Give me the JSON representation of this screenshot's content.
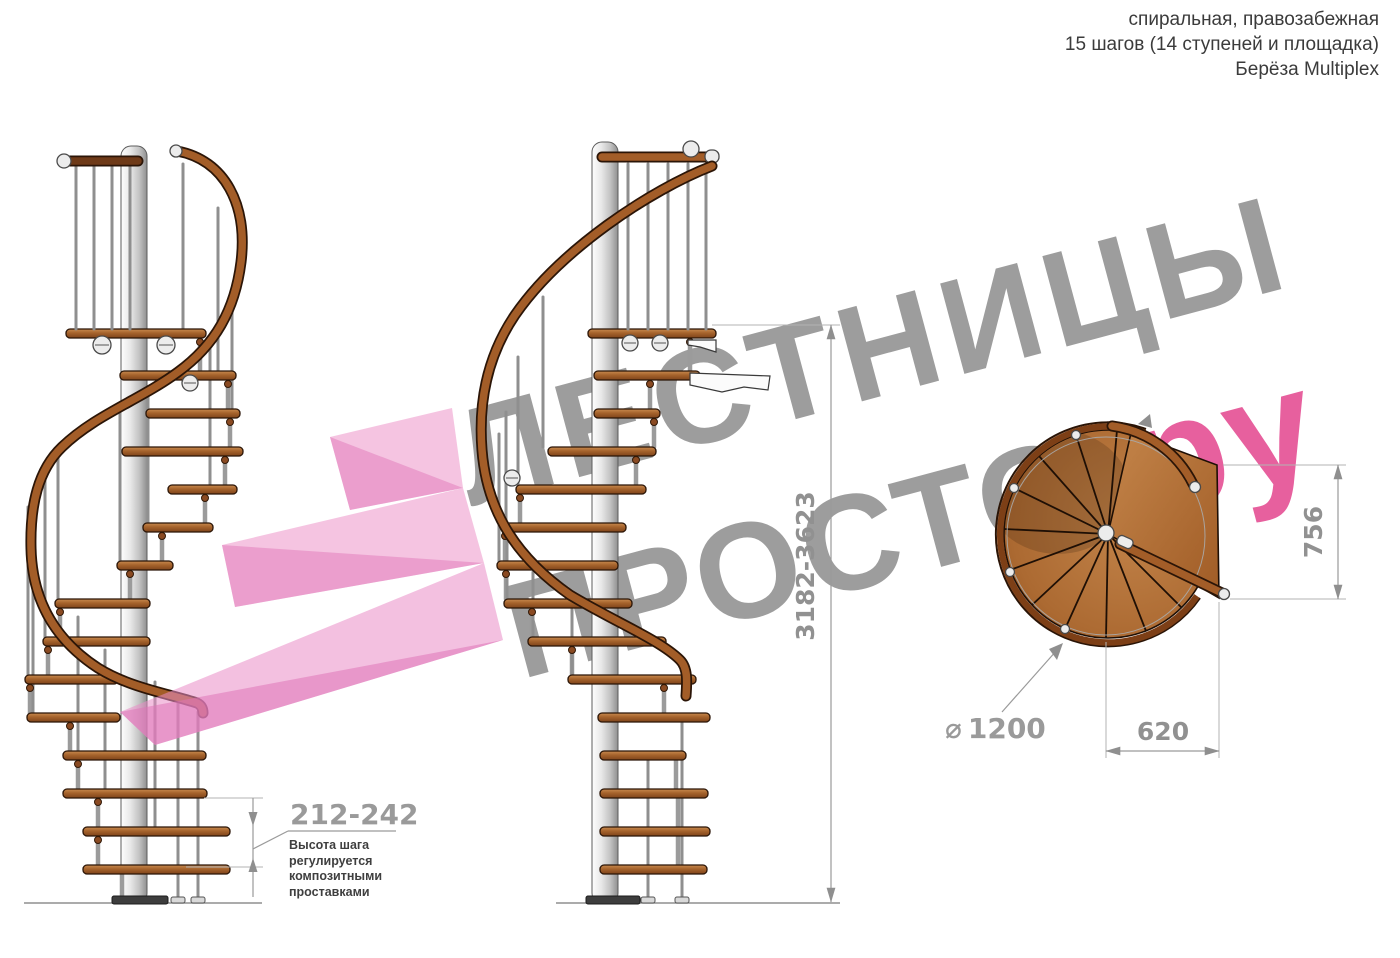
{
  "header": {
    "line1": "спиральная, правозабежная",
    "line2": "15 шагов (14 ступеней и площадка)",
    "line3": "Берёза Multiplex"
  },
  "watermark": {
    "word1": "ЛЕСТНИЦЫ",
    "word2": "ПРОСТО",
    "word2_suffix": ".ру"
  },
  "dimensions": {
    "total_height": "3182-3623",
    "step_height": "212-242",
    "step_height_note": "Высота шага\nрегулируется\nкомпозитными\nпроставками",
    "landing_depth": "756",
    "landing_width": "620",
    "diameter_symbol": "⌀",
    "diameter": "1200"
  },
  "colors": {
    "wood_mid": "#a5632c",
    "wood_dark": "#2b1507",
    "metal_gray": "#d9d9d9",
    "dimension_gray": "#919191",
    "watermark_gray": "#9d9d9d",
    "brand_pink": "#e7609e",
    "logo_pink_light": "#ec93c9",
    "logo_pink_dark": "#e27fbd"
  }
}
